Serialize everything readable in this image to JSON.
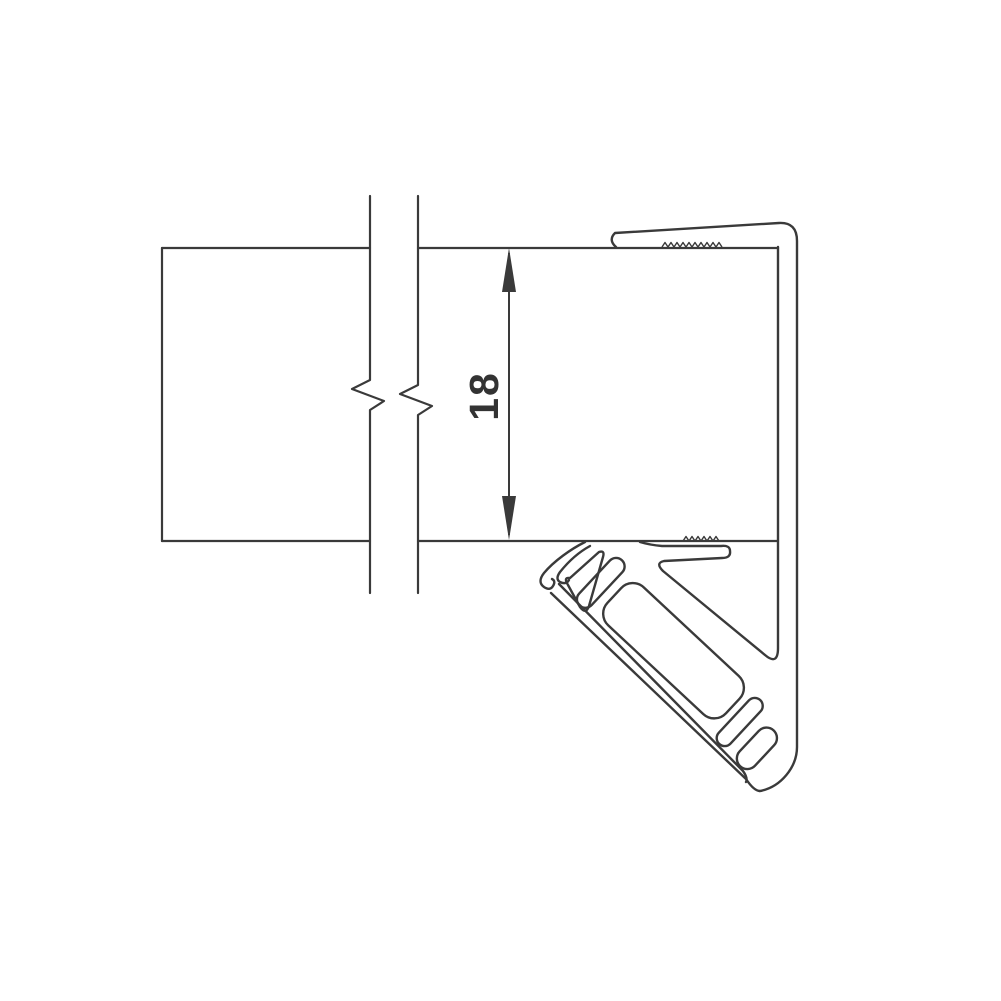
{
  "figure": {
    "type": "technical-section-drawing",
    "description": "Cross-section of a glass panel edge with U-channel frame profile and 45-degree seal lip",
    "dimension": {
      "value": "18"
    },
    "colors": {
      "line": "#3a3a3a",
      "dimension_text": "#333333",
      "background": "#ffffff"
    }
  }
}
